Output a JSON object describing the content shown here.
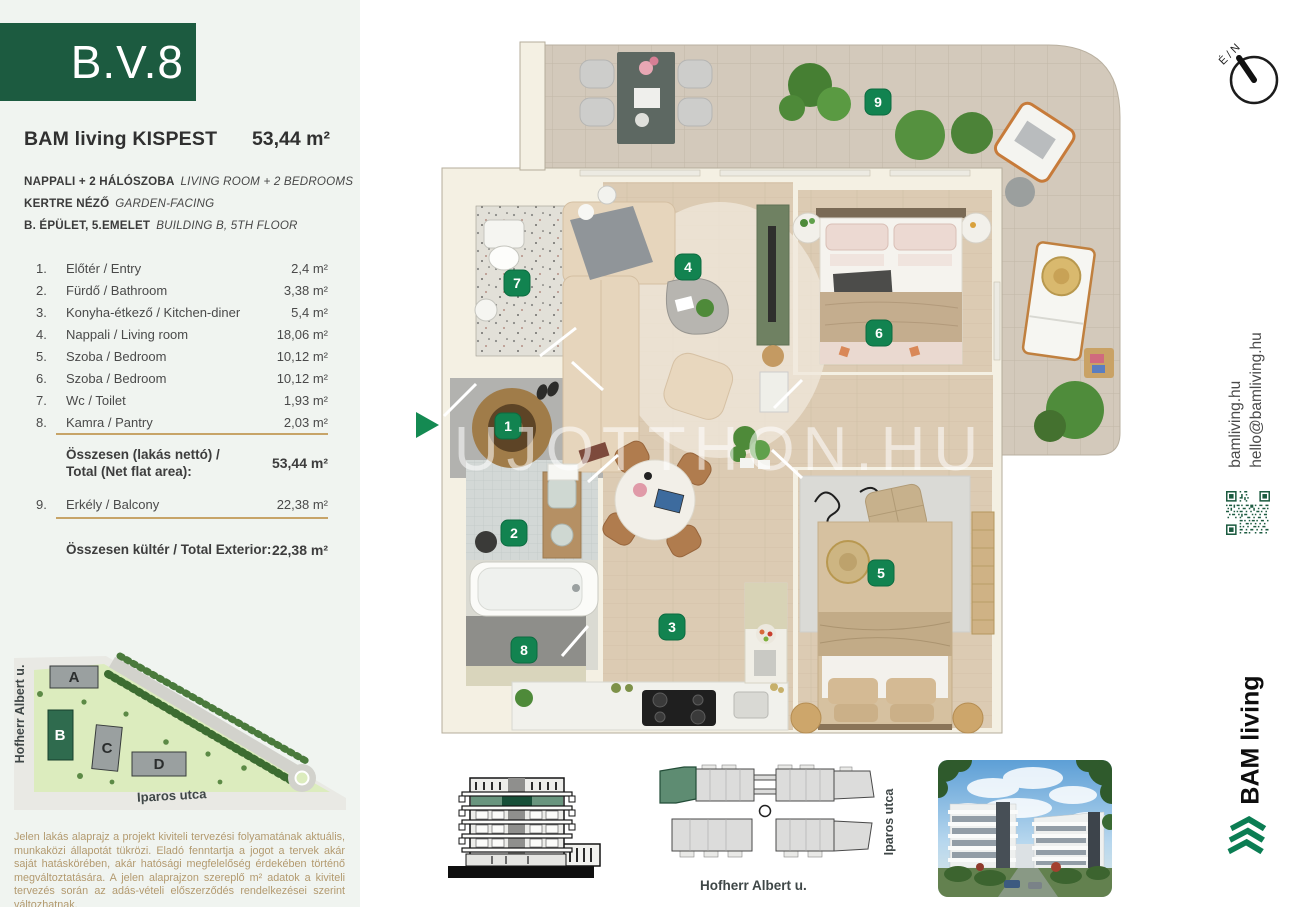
{
  "unit_code": "B.V.8",
  "header": {
    "project": "BAM living KISPEST",
    "area": "53,44 m²"
  },
  "specs": [
    {
      "hu": "NAPPALI + 2 HÁLÓSZOBA",
      "en": "LIVING ROOM + 2 BEDROOMS"
    },
    {
      "hu": "KERTRE NÉZŐ",
      "en": "GARDEN-FACING"
    },
    {
      "hu": "B. ÉPÜLET, 5.EMELET",
      "en": "BUILDING B, 5TH FLOOR"
    }
  ],
  "rooms": [
    {
      "num": "1.",
      "name": "Előtér / Entry",
      "area": "2,4 m²"
    },
    {
      "num": "2.",
      "name": "Fürdő / Bathroom",
      "area": "3,38 m²"
    },
    {
      "num": "3.",
      "name": "Konyha-étkező / Kitchen-diner",
      "area": "5,4 m²"
    },
    {
      "num": "4.",
      "name": "Nappali / Living room",
      "area": "18,06 m²"
    },
    {
      "num": "5.",
      "name": "Szoba / Bedroom",
      "area": "10,12 m²"
    },
    {
      "num": "6.",
      "name": "Szoba / Bedroom",
      "area": "10,12 m²"
    },
    {
      "num": "7.",
      "name": "Wc / Toilet",
      "area": "1,93 m²"
    },
    {
      "num": "8.",
      "name": "Kamra / Pantry",
      "area": "2,03 m²"
    }
  ],
  "totals": {
    "net_label_1": "Összesen (lakás nettó) /",
    "net_label_2": "Total (Net flat area):",
    "net_value": "53,44 m²",
    "exterior_label": "Összesen kültér / Total Exterior:",
    "exterior_value": "22,38 m²"
  },
  "balcony_row": {
    "num": "9.",
    "name": "Erkély / Balcony",
    "area": "22,38 m²"
  },
  "floor_plan": {
    "markers": [
      "1",
      "2",
      "3",
      "4",
      "5",
      "6",
      "7",
      "8",
      "9"
    ],
    "watermark": "UJOTTHON.HU",
    "compass": "É / N"
  },
  "site_map": {
    "buildings": [
      "A",
      "B",
      "C",
      "D"
    ],
    "street_left": "Hofherr Albert u.",
    "street_bottom": "Iparos utca"
  },
  "key_plan": {
    "street_bottom": "Hofherr Albert u.",
    "street_right": "Iparos utca"
  },
  "contact": {
    "website": "bamliving.hu",
    "email": "hello@bamliving.hu"
  },
  "brand": {
    "name": "BAM living"
  },
  "disclaimer": "Jelen lakás alaprajz a projekt kiviteli tervezési folyamatának aktuális, munkaközi állapotát tükrözi. Eladó fenntartja a jogot a tervek akár saját hatáskörében, akár hatósági megfelelőség érdekében történő megváltoztatására. A jelen alaprajzon szereplő m² adatok a kiviteli tervezés során az adás-vételi előszerződés rendelkezései szerint változhatnak.",
  "colors": {
    "brand_green": "#1c5b40",
    "marker_green": "#128350",
    "accent_gold": "#c7a468",
    "disclaimer_tan": "#b39a6f",
    "sidebar_bg": "#f0f4f0"
  }
}
